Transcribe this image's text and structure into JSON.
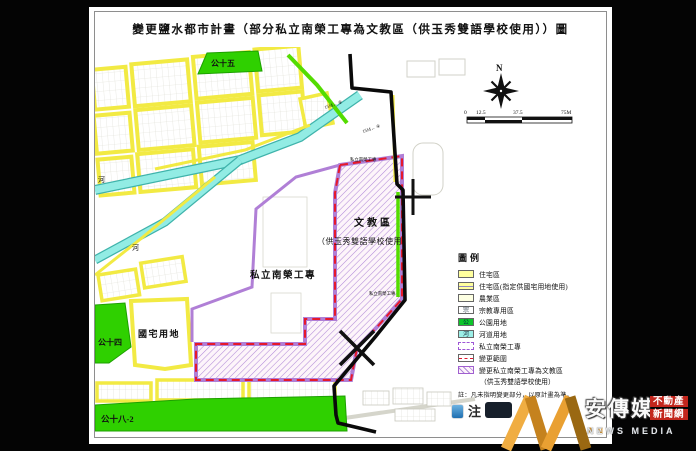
{
  "page": {
    "title": "變更鹽水都市計畫（部分私立南榮工專為文教區（供玉秀雙語學校使用））圖"
  },
  "map": {
    "labels": {
      "park15": "公十五",
      "park14": "公十四",
      "park18": "公十八-2",
      "river1": "河",
      "river2": "河",
      "public_housing": "國宅用地",
      "campus_big": "私立南榮工專",
      "campus_top": "私立南榮工專",
      "campus_right": "私立南榮工專",
      "edu_zone_line1": "文教區",
      "edu_zone_line2": "（供玉秀雙語學校使用）",
      "road1": "15M← ⑧",
      "road2": "15M← ④"
    },
    "north_label": "N",
    "scale": {
      "t0": "0",
      "t1": "12.5",
      "t2": "37.5",
      "t3": "75M"
    }
  },
  "legend": {
    "title": "圖例",
    "items": [
      {
        "label": "住宅區",
        "swatch": "residential"
      },
      {
        "label": "住宅區(指定供國宅用地使用)",
        "swatch": "residential-housing"
      },
      {
        "label": "農業區",
        "swatch": "agriculture"
      },
      {
        "label": "宗教專用區",
        "swatch": "religion",
        "swatch_char": "宗"
      },
      {
        "label": "公園用地",
        "swatch": "park",
        "swatch_char": "公"
      },
      {
        "label": "河道用地",
        "swatch": "river",
        "swatch_char": "河"
      },
      {
        "label": "私立南榮工專",
        "swatch": "campus"
      },
      {
        "label": "變更範圍",
        "swatch": "change-boundary"
      },
      {
        "label": "變更私立南榮工專為文教區",
        "label2": "（供玉秀雙語學校使用）",
        "swatch": "change-area"
      }
    ],
    "note": "註：凡未指明變更部分，以原計畫為準。"
  },
  "watermark": {
    "brand": "安傳媒",
    "sub_an": "AN",
    "sub_rest": "NEWS MEDIA",
    "tag1": "不動產",
    "tag2": "新聞網",
    "note_label": "注"
  },
  "colors": {
    "residential_yellow": "#f2ea43",
    "park_green": "#2fd000",
    "river_cyan": "#92ece4",
    "campus_purple": "#b07fd6",
    "change_red": "#e6192b",
    "boundary_black": "#0a0a0a",
    "watermark_gold": "#d9952d",
    "tag_red": "#c3261d"
  }
}
